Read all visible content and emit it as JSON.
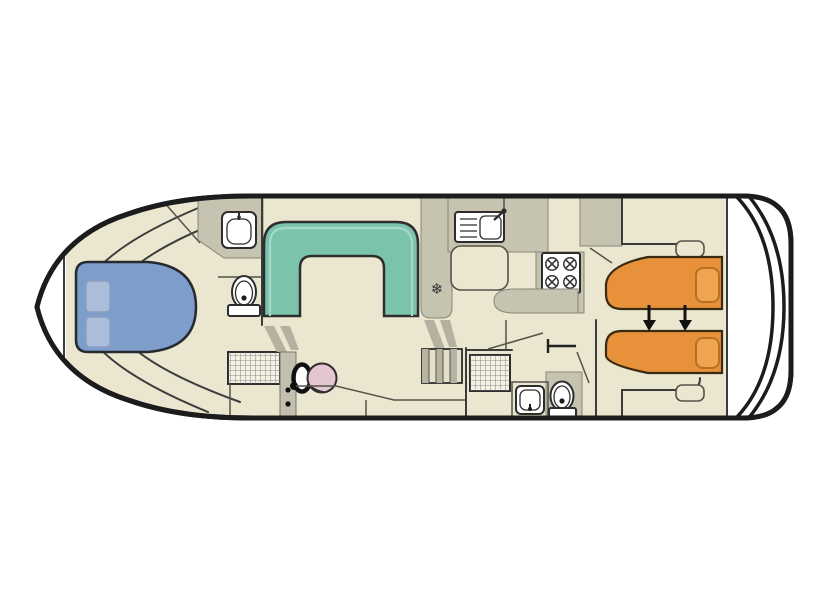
{
  "diagram": {
    "kind": "boat-deck-floor-plan",
    "orientation": "bow-left-stern-right"
  },
  "colors": {
    "hull_outline": "#1c1c1c",
    "wall": "#3c3c3c",
    "floor": "#eae6cf",
    "wet_area": "#c7c3b1",
    "deck_white": "#ffffff",
    "double_bed": "#7d9dca",
    "double_bed_pillow": "#abbdd9",
    "dinette_seat": "#7cc3ae",
    "dinette_seat_inner": "#a6d8c7",
    "single_bed": "#e8913b",
    "single_bed_pillow": "#efa44f",
    "helm_seat": "#e4c6d2",
    "arrow": "#111111"
  },
  "icons": {
    "fridge_glyph": "❄"
  },
  "fixtures": [
    {
      "id": "bow-deck",
      "label": "bow-deck"
    },
    {
      "id": "double-bed",
      "label": "double-bed-with-two-pillows"
    },
    {
      "id": "bow-washbasin",
      "label": "washbasin"
    },
    {
      "id": "bow-toilet",
      "label": "toilet"
    },
    {
      "id": "bow-shower",
      "label": "shower-tray"
    },
    {
      "id": "dinette",
      "label": "u-shaped-dinette-seating"
    },
    {
      "id": "helm-wheel",
      "label": "steering-wheel"
    },
    {
      "id": "helm-seat",
      "label": "helm-seat"
    },
    {
      "id": "companionway-steps",
      "label": "steps"
    },
    {
      "id": "fridge",
      "label": "refrigerator-freezer"
    },
    {
      "id": "galley-sink",
      "label": "sink-with-drainer-and-tap"
    },
    {
      "id": "stove",
      "label": "four-burner-hob"
    },
    {
      "id": "mid-shower",
      "label": "shower-tray"
    },
    {
      "id": "aft-washbasin",
      "label": "washbasin"
    },
    {
      "id": "aft-toilet",
      "label": "toilet"
    },
    {
      "id": "wardrobe",
      "label": "wardrobe"
    },
    {
      "id": "single-beds",
      "label": "twin-single-beds-slide-together"
    },
    {
      "id": "stern-deck",
      "label": "stern-swim-deck"
    }
  ]
}
